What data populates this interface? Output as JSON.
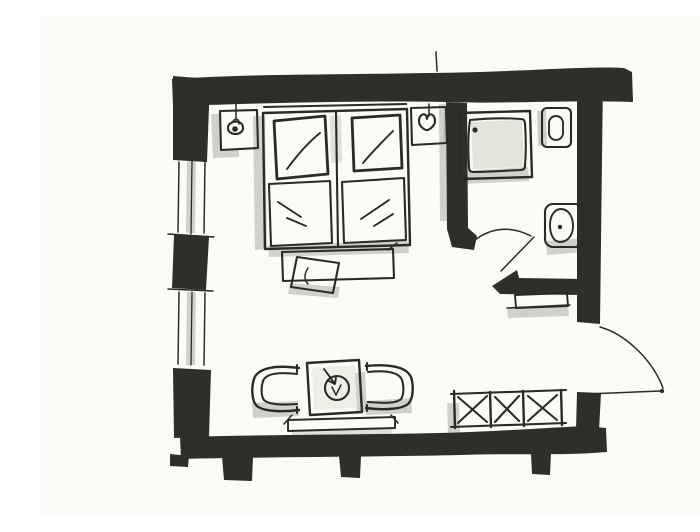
{
  "colors": {
    "paper": "#fbfbf7",
    "ink": "#2b2a27",
    "wall": "#2f2e2b",
    "marker": "#aeaea6",
    "marker_light": "#e4e4da"
  },
  "floorplan": {
    "style": "hand-drawn black marker floor plan sketch",
    "rooms": [
      {
        "name": "bedroom",
        "furniture": [
          "double-bed",
          "pillow-left",
          "pillow-right",
          "duvet-left",
          "duvet-right",
          "nightstand-left",
          "nightstand-right",
          "bedside-lamp-left",
          "bedside-lamp-right",
          "foot-bench",
          "bench-tray",
          "armchair-left",
          "armchair-right",
          "side-table",
          "table-centerpiece",
          "window-bench",
          "wardrobe-rack",
          "hanging-clothes"
        ]
      },
      {
        "name": "bathroom",
        "furniture": [
          "shower-tray",
          "shower-drain",
          "washbasin",
          "toilet",
          "wall-shelf"
        ]
      }
    ],
    "openings": [
      "entry-door",
      "entry-door-swing-arc",
      "bathroom-door",
      "bathroom-door-swing-arc",
      "window-left-upper",
      "window-left-lower"
    ]
  }
}
